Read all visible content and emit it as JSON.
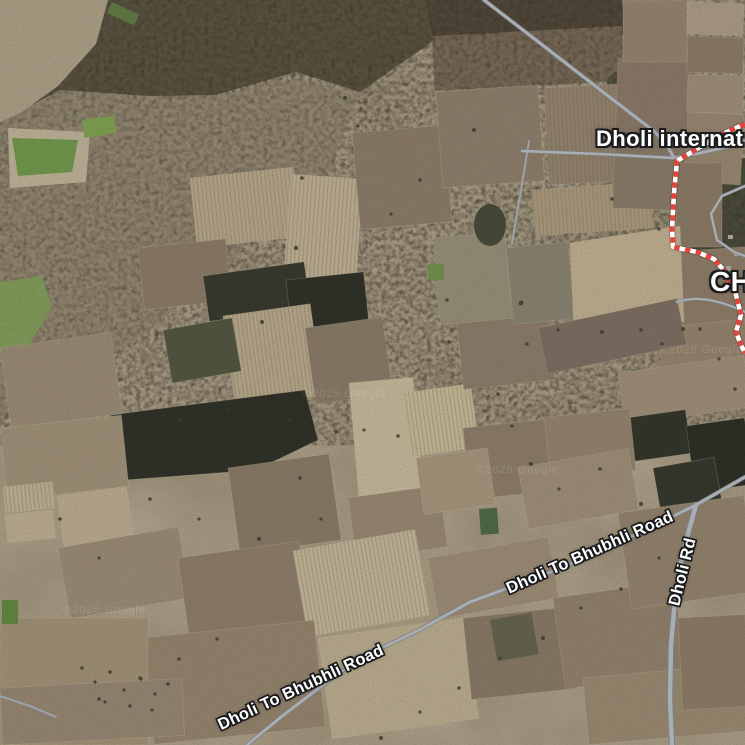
{
  "map": {
    "view_type": "satellite",
    "labels": {
      "place_primary": "Dholi internat",
      "place_secondary": "CH",
      "road_main": "Dholi To Bhubhli Road",
      "road_side": "Dholi Rd"
    },
    "watermark": "©2025 Google",
    "colors": {
      "boundary_red": "#e8433a",
      "boundary_white": "#ffffff",
      "road_fill": "#a9aeb3",
      "road_casing": "#7a7f85",
      "label_text": "#ffffff"
    }
  }
}
